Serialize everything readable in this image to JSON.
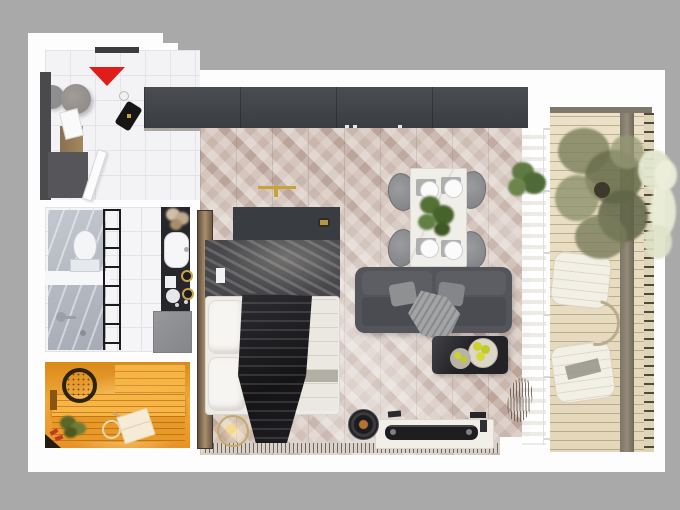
{
  "scene": {
    "type": "3d-rendered-apartment-floor-plan-top-view",
    "title": "Studio apartment floor plan render",
    "rooms": [
      {
        "label": "Entry hall",
        "objects": [
          "entrance door",
          "red direction triangle",
          "two gray poufs",
          "wardrobe console with clothes",
          "black bag",
          "open white door leaf",
          "white tile floor"
        ]
      },
      {
        "label": "Wardrobe unit",
        "objects": [
          "long dark gray built-in wardrobe along top wall"
        ]
      },
      {
        "label": "Living / bedroom",
        "objects": [
          "herringbone parquet floor",
          "bed with white pillows and dark draped blanket",
          "dark headboard dresser with gold emblem",
          "tall bronze mirror strip",
          "round pendant lamp",
          "dining table with four plates and green centerpiece",
          "four gray chairs",
          "dark gray sofa with cushions and throw",
          "black coffee table with two plates of yellow fruit",
          "white TV console with dark TV bar",
          "round speaker with copper center",
          "green plant",
          "dried grass in vase",
          "sheer white curtain",
          "radiator grille strip"
        ]
      },
      {
        "label": "Bathroom",
        "objects": [
          "gray marble shower and toilet column",
          "white toilet",
          "shower fixture",
          "black ladder towel rack",
          "white tile floor",
          "black vanity with white oval sink",
          "flowers",
          "gold-ringed jars",
          "gray washing machine"
        ]
      },
      {
        "label": "Sauna",
        "objects": [
          "warm orange wood benches",
          "woven bucket",
          "green sauna whisk",
          "wooden ladle",
          "white towel"
        ]
      },
      {
        "label": "Balcony",
        "objects": [
          "cream plank decking",
          "olive tree in pot",
          "pale foliage overhanging edge",
          "dark wood walkway strip",
          "railing with tick posts",
          "two white lounge chairs",
          "curved side table"
        ]
      }
    ],
    "palette": {
      "background_gray": "#a9a9a9",
      "canvas_white": "#fdfdfd",
      "accent_red_triangle": "#e11d1b",
      "wardrobe_dark": "#43464a",
      "parquet_taupe": "#cdbcb2",
      "sofa_gray": "#54555b",
      "coffee_table_black": "#232327",
      "fruit_yellow": "#ccd22e",
      "sauna_orange": "#f0a93c",
      "balcony_deck_cream": "#e9dfc6",
      "bathroom_marble": "#b7bbc3",
      "vanity_black": "#27272b",
      "bed_blanket_black": "#1d1d22",
      "brass_gold": "#c9a23e"
    }
  }
}
